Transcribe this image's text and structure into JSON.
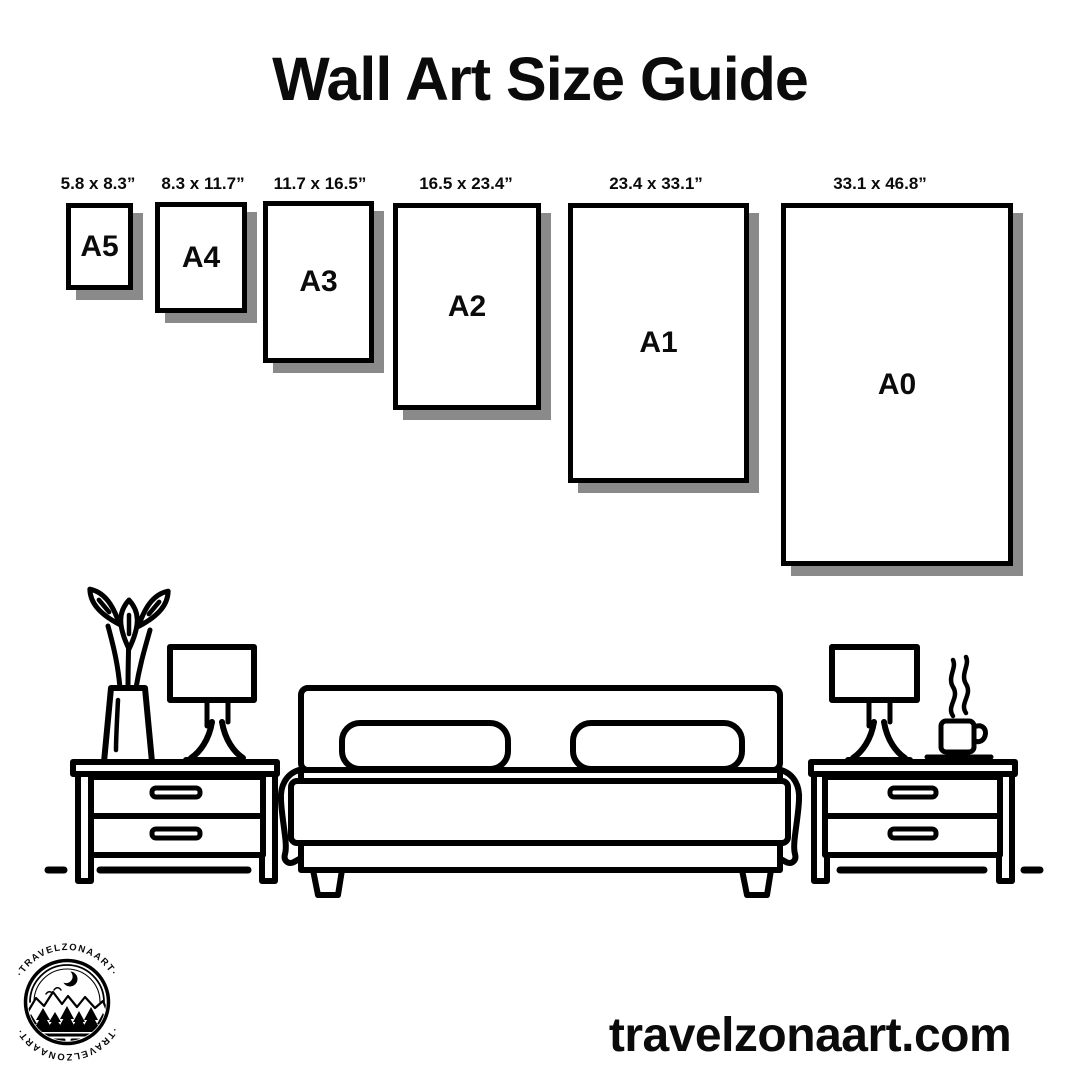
{
  "page": {
    "title": "Wall Art Size Guide",
    "website": "travelzonaart.com"
  },
  "sizes": [
    {
      "code": "A5",
      "inches": "5.8 x 8.3”"
    },
    {
      "code": "A4",
      "inches": "8.3 x 11.7”"
    },
    {
      "code": "A3",
      "inches": "11.7 x 16.5”"
    },
    {
      "code": "A2",
      "inches": "16.5 x 23.4”"
    },
    {
      "code": "A1",
      "inches": "23.4 x 33.1”"
    },
    {
      "code": "A0",
      "inches": "33.1 x 46.8”"
    }
  ],
  "logo": {
    "ring_text_top": "·TRAVELZONAART·",
    "ring_text_bottom": "·TRAVELZONAART·"
  },
  "colors": {
    "ink": "#000000",
    "shadow": "#8a8a8a",
    "background": "#ffffff"
  }
}
